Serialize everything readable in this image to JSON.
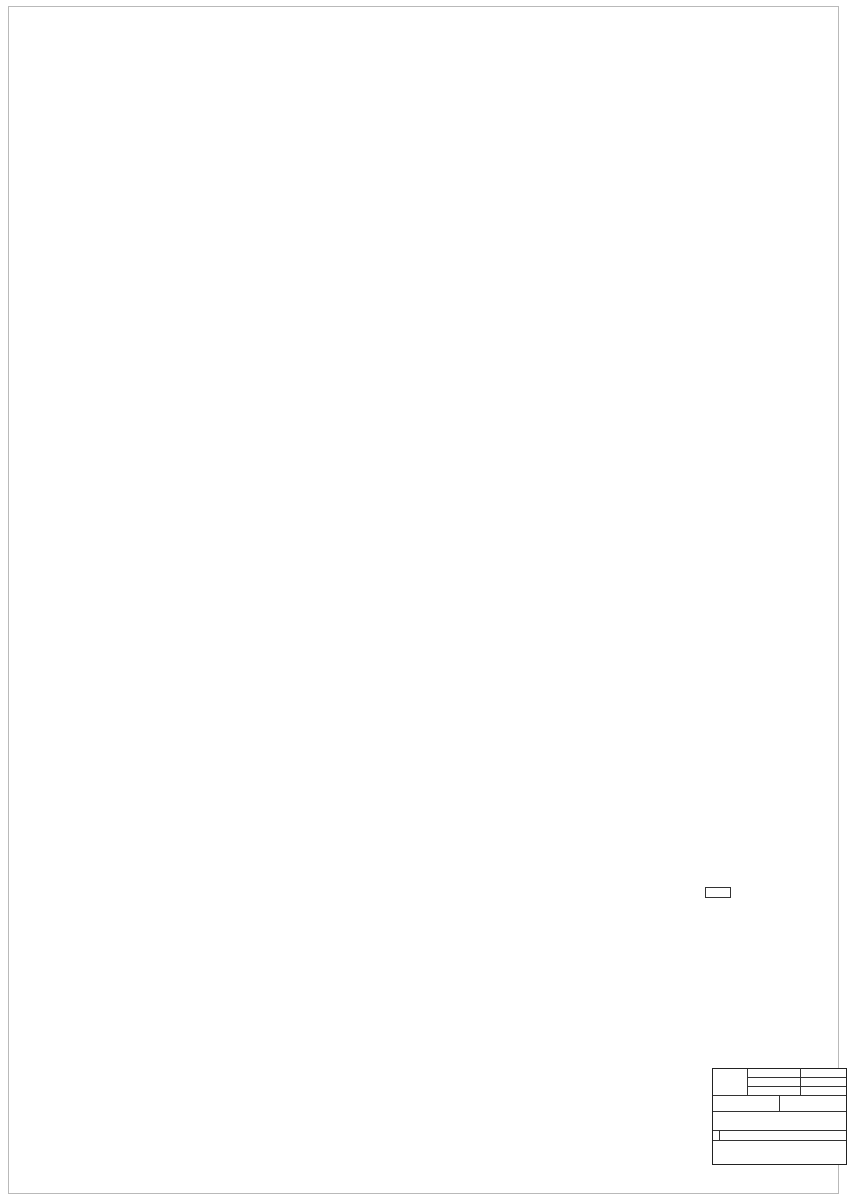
{
  "legend_materials": {
    "title": "LEGENDA MATERIÁLŮ",
    "items": [
      {
        "label": "STÁVAJÍCÍ CIHELNÉ ZDIVO",
        "swatch": "#c4c4c4"
      }
    ]
  },
  "legend_rooms": {
    "title": "LEGENDA MÍSTNOSTÍ",
    "headers": [
      "Č.M.",
      "NÁZEV MÍSTNOSTI",
      "PLOCHA m2",
      "DRUH PODLAHY"
    ],
    "rows": [
      [
        "101",
        "HALA",
        "95,30",
        "BETON"
      ],
      [
        "102",
        "SKLAD",
        "28,5",
        "BETON"
      ],
      [
        "103",
        "SKLAD",
        "39,45",
        "BETON"
      ],
      [
        "104",
        "CHODBA",
        "15,80",
        "BETON"
      ],
      [
        "105",
        "SCHODIŠTĚ",
        "3,30",
        "BETON"
      ],
      [
        "106",
        "SKLAD",
        "18,46",
        "BETON"
      ],
      [
        "107",
        "WC",
        "2,75",
        "BETON"
      ],
      [
        "108",
        "SKLAD",
        "56,1",
        "BETON"
      ],
      [
        "109",
        "SKLAD",
        "17,90",
        "BETON"
      ],
      [
        "110",
        "SKLAD",
        "22,80",
        "BETON"
      ]
    ],
    "footer_line1": "CELKOVÁ UŽITNÁ PLOCHA",
    "footer_line2": "1NP OBJEKTU JE - 300,3 M2"
  },
  "titleblock": {
    "datum_label": "DATUM",
    "datum": "4/2025",
    "stupen_label": "STUPEŇ",
    "stupen": "PASPORT",
    "format_label": "FORMÁT",
    "format": "A1",
    "meritko_label": "MĚŘÍTKO",
    "meritko": "1:50",
    "cislo_label": "Č.",
    "cislo": "D1.1 - 1",
    "rows": [
      [
        "AUTORIZOVANÝ PROJEKTANT",
        "ING. MIROSLAV KRAMÁŘ"
      ],
      [
        "VYPRACOVAL",
        "ING. TOMÁŠ CHUDÝ"
      ],
      [
        "OBEC",
        "OKROUHLICE"
      ],
      [
        "KATASTRÁLNÍ ÚZEMÍ",
        "OKROUHLICE (709654)"
      ],
      [
        "INVESTOR",
        "B1 KLIMA a.s. HYBEŠOVA 256/18, STARÉ BRNO, 60200 BRNO"
      ]
    ],
    "stavba_label": "STAVBA",
    "stavba": "OKROUHLICE Č. PO. 58, PA. Č. 67/3",
    "part_code": "D.1.1",
    "part_name": "ARCHITEKTONICKO-STAVEBNÍ ŘEŠENÍ",
    "obsah_label": "OBSAH",
    "obsah": "PŮDORYS 1NP - STÁVAJÍCÍ STAV"
  },
  "plan": {
    "accent_dim_color": "#3b3bb0",
    "room_color": "#2ba2a2",
    "neighbor_color_top": "#63cfcf",
    "neighbor_color_bottom": "#dd9a55",
    "rooms": [
      {
        "num": "1.01",
        "name": "HALA",
        "x": 520,
        "y": 268
      },
      {
        "num": "1.02",
        "name": "SKLAD",
        "x": 268,
        "y": 272
      },
      {
        "num": "1.03",
        "name": "SKLAD",
        "x": 270,
        "y": 521
      },
      {
        "num": "1.04",
        "name": "CHODBA",
        "x": 388,
        "y": 532
      },
      {
        "num": "1.05",
        "name": "SCHODIŠTĚ",
        "x": 489,
        "y": 545
      },
      {
        "num": "1.06",
        "name": "SKLAD",
        "x": 579,
        "y": 464
      },
      {
        "num": "1.07",
        "name": "WC",
        "x": 377,
        "y": 630
      },
      {
        "num": "1.08",
        "name": "SKLAD",
        "x": 423,
        "y": 643
      },
      {
        "num": "1.09",
        "name": "SKLAD",
        "x": 413,
        "y": 786
      },
      {
        "num": "1.10",
        "name": "SKLAD",
        "x": 542,
        "y": 786
      }
    ],
    "levels": [
      {
        "x": 512,
        "y": 203,
        "t": "0,000",
        "sv": "SV. 3950"
      },
      {
        "x": 275,
        "y": 322,
        "t": "0,000",
        "sv": "SV. 3950"
      },
      {
        "x": 298,
        "y": 402,
        "t": "0,000",
        "sv": "SV. 3950"
      },
      {
        "x": 290,
        "y": 502,
        "t": "0,000",
        "sv": "SV. 3200"
      },
      {
        "x": 408,
        "y": 551,
        "t": "-0,050",
        "sv": "SV. 3000"
      },
      {
        "x": 614,
        "y": 466,
        "t": "0,000",
        "sv": "SV. 2520"
      },
      {
        "x": 470,
        "y": 562,
        "t": "+1,180"
      },
      {
        "x": 412,
        "y": 667,
        "t": "-0,250",
        "sv": "SV. 2950"
      },
      {
        "x": 591,
        "y": 667,
        "t": "-0,250",
        "sv": "SV. 2950"
      },
      {
        "x": 413,
        "y": 803,
        "t": "-0,250",
        "sv": "SV. 2500"
      },
      {
        "x": 542,
        "y": 803,
        "t": "-0,250",
        "sv": "SV. 2500"
      },
      {
        "x": 303,
        "y": 147,
        "t": "-0,030"
      },
      {
        "x": 471,
        "y": 117,
        "t": "-0,625"
      },
      {
        "x": 485,
        "y": 139,
        "t": "-0,315"
      }
    ],
    "dims": [
      {
        "x": 630,
        "y": 48,
        "t": "17600"
      },
      {
        "x": 255,
        "y": 60,
        "t": "5600"
      },
      {
        "x": 515,
        "y": 60,
        "t": "12100"
      },
      {
        "x": 228,
        "y": 74,
        "t": "2310"
      },
      {
        "x": 340,
        "y": 74,
        "t": "2630"
      },
      {
        "x": 436,
        "y": 74,
        "t": "560"
      },
      {
        "x": 470,
        "y": 74,
        "t": "1690"
      },
      {
        "x": 552,
        "y": 71,
        "t": "1260"
      },
      {
        "x": 552,
        "y": 77,
        "t": "2130(870)",
        "fs": 3.2
      },
      {
        "x": 600,
        "y": 74,
        "t": "1150"
      },
      {
        "x": 633,
        "y": 74,
        "t": "1170"
      },
      {
        "x": 666,
        "y": 71,
        "t": "2320(970)",
        "fs": 3.2
      },
      {
        "x": 686,
        "y": 74,
        "t": "1610"
      },
      {
        "x": 200,
        "y": 86,
        "t": "590"
      },
      {
        "x": 240,
        "y": 86,
        "t": "1720"
      },
      {
        "x": 292,
        "y": 84,
        "t": "1200"
      },
      {
        "x": 292,
        "y": 90,
        "t": "2110(870)",
        "fs": 3.2
      },
      {
        "x": 352,
        "y": 84,
        "t": "1430"
      },
      {
        "x": 352,
        "y": 90,
        "t": "2000"
      },
      {
        "x": 460,
        "y": 86,
        "t": "1200"
      },
      {
        "x": 460,
        "y": 92,
        "t": "2110(870)",
        "fs": 3.2
      },
      {
        "x": 528,
        "y": 86,
        "t": "2000"
      },
      {
        "x": 590,
        "y": 84,
        "t": "1200"
      },
      {
        "x": 590,
        "y": 90,
        "t": "2110(880)",
        "fs": 3.2
      },
      {
        "x": 650,
        "y": 86,
        "t": "1670"
      },
      {
        "x": 528,
        "y": 96,
        "t": "2700"
      },
      {
        "x": 512,
        "y": 104,
        "t": "2100"
      },
      {
        "x": 558,
        "y": 104,
        "t": "600"
      },
      {
        "x": 578,
        "y": 134,
        "t": "1450",
        "r": 1
      },
      {
        "x": 536,
        "y": 121,
        "t": "140 160/230",
        "fs": 3
      },
      {
        "x": 544,
        "y": 129,
        "t": "2x740(2x160)-2x780",
        "fs": 3
      },
      {
        "x": 115,
        "y": 520,
        "t": "25290",
        "r": 1
      },
      {
        "x": 128,
        "y": 345,
        "t": "11050",
        "r": 1
      },
      {
        "x": 128,
        "y": 765,
        "t": "5840",
        "r": 1
      },
      {
        "x": 144,
        "y": 170,
        "t": "870",
        "r": 1
      },
      {
        "x": 144,
        "y": 200,
        "t": "1140",
        "r": 1
      },
      {
        "x": 144,
        "y": 235,
        "t": "1580(2110)",
        "r": 1,
        "fs": 3.2
      },
      {
        "x": 144,
        "y": 300,
        "t": "4350",
        "r": 1
      },
      {
        "x": 144,
        "y": 362,
        "t": "1020",
        "r": 1
      },
      {
        "x": 144,
        "y": 422,
        "t": "1970",
        "r": 1
      },
      {
        "x": 144,
        "y": 468,
        "t": "980",
        "r": 1
      },
      {
        "x": 144,
        "y": 502,
        "t": "490",
        "r": 1
      },
      {
        "x": 144,
        "y": 535,
        "t": "1000(1700)",
        "r": 1,
        "fs": 3.2
      },
      {
        "x": 144,
        "y": 572,
        "t": "1530",
        "r": 1
      },
      {
        "x": 160,
        "y": 592,
        "t": "520",
        "r": 1,
        "fs": 3.4
      },
      {
        "x": 144,
        "y": 618,
        "t": "1170",
        "r": 1
      },
      {
        "x": 144,
        "y": 648,
        "t": "870",
        "r": 1
      },
      {
        "x": 144,
        "y": 678,
        "t": "1170",
        "r": 1
      },
      {
        "x": 144,
        "y": 712,
        "t": "1000",
        "r": 1
      },
      {
        "x": 144,
        "y": 755,
        "t": "1320",
        "r": 1
      },
      {
        "x": 144,
        "y": 835,
        "t": "3960",
        "r": 1
      },
      {
        "x": 716,
        "y": 350,
        "t": "13325",
        "r": 1
      },
      {
        "x": 676,
        "y": 387,
        "t": "710",
        "fs": 3.4
      },
      {
        "x": 659,
        "y": 397,
        "t": "900",
        "fs": 3.4
      },
      {
        "x": 242,
        "y": 899,
        "t": "5490"
      },
      {
        "x": 362,
        "y": 899,
        "t": "1715"
      },
      {
        "x": 404,
        "y": 897,
        "t": "1000"
      },
      {
        "x": 404,
        "y": 903,
        "t": "1470(810)",
        "fs": 3.2
      },
      {
        "x": 446,
        "y": 899,
        "t": "1970"
      },
      {
        "x": 512,
        "y": 897,
        "t": "1000"
      },
      {
        "x": 512,
        "y": 903,
        "t": "1560(810)",
        "fs": 3.2
      },
      {
        "x": 550,
        "y": 906,
        "t": "1590",
        "fs": 3.6
      },
      {
        "x": 625,
        "y": 899,
        "t": "5905"
      },
      {
        "x": 424,
        "y": 911,
        "t": "17280"
      },
      {
        "x": 545,
        "y": 919,
        "t": "(11590)",
        "fs": 3.4
      },
      {
        "x": 270,
        "y": 287,
        "t": "4950"
      },
      {
        "x": 237,
        "y": 302,
        "t": "3060"
      },
      {
        "x": 303,
        "y": 300,
        "t": "1270"
      },
      {
        "x": 303,
        "y": 306,
        "t": "2100"
      },
      {
        "x": 333,
        "y": 302,
        "t": "620"
      },
      {
        "x": 215,
        "y": 290,
        "t": "650",
        "fs": 3.4
      },
      {
        "x": 250,
        "y": 388,
        "t": "4960"
      },
      {
        "x": 222,
        "y": 396,
        "t": "1120"
      },
      {
        "x": 290,
        "y": 396,
        "t": "3180"
      },
      {
        "x": 278,
        "y": 403,
        "t": "2270"
      },
      {
        "x": 552,
        "y": 382,
        "t": "10950"
      },
      {
        "x": 540,
        "y": 390,
        "t": "5530"
      },
      {
        "x": 612,
        "y": 390,
        "t": "1900"
      },
      {
        "x": 648,
        "y": 390,
        "t": "2300(2150)",
        "fs": 3
      },
      {
        "x": 390,
        "y": 388,
        "t": "1170",
        "fs": 3.4
      },
      {
        "x": 417,
        "y": 389,
        "t": "1250"
      },
      {
        "x": 417,
        "y": 396,
        "t": "2200"
      },
      {
        "x": 449,
        "y": 240,
        "t": "4750",
        "r": 1
      },
      {
        "x": 457,
        "y": 310,
        "t": "8700",
        "r": 1
      },
      {
        "x": 437,
        "y": 375,
        "t": "3170",
        "r": 1,
        "fs": 3.4
      },
      {
        "x": 462,
        "y": 322,
        "t": "780",
        "fs": 3.2
      },
      {
        "x": 212,
        "y": 460,
        "t": "1290"
      },
      {
        "x": 280,
        "y": 468,
        "t": "8750"
      },
      {
        "x": 246,
        "y": 505,
        "t": "4410",
        "r": 1
      },
      {
        "x": 381,
        "y": 505,
        "t": "580",
        "fs": 3.4
      },
      {
        "x": 404,
        "y": 518,
        "t": "1650"
      },
      {
        "x": 438,
        "y": 546,
        "t": "1100",
        "fs": 3.4
      },
      {
        "x": 464,
        "y": 546,
        "t": "1410",
        "fs": 3.4
      },
      {
        "x": 433,
        "y": 481,
        "t": "4250"
      },
      {
        "x": 586,
        "y": 483,
        "t": "4675"
      },
      {
        "x": 645,
        "y": 474,
        "t": "600",
        "fs": 3.4
      },
      {
        "x": 612,
        "y": 492,
        "t": "2875"
      },
      {
        "x": 612,
        "y": 533,
        "t": "2875"
      },
      {
        "x": 600,
        "y": 566,
        "t": "3615"
      },
      {
        "x": 608,
        "y": 500,
        "t": "2030(2060)",
        "fs": 3
      },
      {
        "x": 393,
        "y": 597,
        "t": "110",
        "fs": 3
      },
      {
        "x": 407,
        "y": 597,
        "t": "1170",
        "fs": 3.4
      },
      {
        "x": 402,
        "y": 604,
        "t": "2260",
        "fs": 3.4
      },
      {
        "x": 412,
        "y": 629,
        "t": "4210"
      },
      {
        "x": 439,
        "y": 615,
        "t": "2950",
        "r": 1,
        "fs": 3.4
      },
      {
        "x": 504,
        "y": 688,
        "t": "9880"
      },
      {
        "x": 424,
        "y": 721,
        "t": "5290"
      },
      {
        "x": 456,
        "y": 710,
        "t": "3050",
        "r": 1,
        "fs": 3.4
      },
      {
        "x": 386,
        "y": 712,
        "t": "1080",
        "fs": 3.4
      },
      {
        "x": 588,
        "y": 629,
        "t": "4170"
      },
      {
        "x": 583,
        "y": 663,
        "t": "8150",
        "r": 1,
        "fs": 3.4
      },
      {
        "x": 600,
        "y": 601,
        "t": "1180",
        "fs": 3.4
      },
      {
        "x": 650,
        "y": 601,
        "t": "1140",
        "fs": 3.4
      },
      {
        "x": 624,
        "y": 608,
        "t": "2000(2150)",
        "fs": 3
      },
      {
        "x": 520,
        "y": 723,
        "t": "470",
        "fs": 3.4
      },
      {
        "x": 588,
        "y": 721,
        "t": "4170"
      },
      {
        "x": 653,
        "y": 721,
        "t": "900",
        "fs": 3.4
      },
      {
        "x": 344,
        "y": 822,
        "t": "440",
        "r": 1,
        "fs": 3.4
      },
      {
        "x": 408,
        "y": 825,
        "t": "3860"
      },
      {
        "x": 441,
        "y": 812,
        "t": "2730",
        "r": 1
      },
      {
        "x": 472,
        "y": 824,
        "t": "320",
        "fs": 3.4
      },
      {
        "x": 553,
        "y": 825,
        "t": "4075"
      },
      {
        "x": 662,
        "y": 812,
        "t": "2730",
        "r": 1
      },
      {
        "x": 487,
        "y": 776,
        "t": "980",
        "fs": 3
      },
      {
        "x": 487,
        "y": 782,
        "t": "2000",
        "fs": 3
      },
      {
        "x": 470,
        "y": 776,
        "t": "300",
        "fs": 3
      }
    ],
    "notes": [
      {
        "x": 723,
        "y": 137,
        "t": "SOUSEDNÍ OBJEKT",
        "c": "#63cfcf",
        "fs": 4
      },
      {
        "x": 567,
        "y": 956,
        "t": "SOUSEDNÍ OBJEKT",
        "c": "#dd9a55",
        "fs": 4
      },
      {
        "x": 659,
        "y": 377,
        "t": "EL.",
        "c": "#333333",
        "fs": 3.2
      },
      {
        "x": 470,
        "y": 459,
        "t": "DRAŽICE",
        "c": "#333333",
        "fs": 2.6
      },
      {
        "x": 463,
        "y": 479,
        "t": "DK01",
        "c": "#333333",
        "fs": 3
      },
      {
        "x": 463,
        "y": 484,
        "t": "DPK03",
        "c": "#333333",
        "fs": 2.8
      },
      {
        "x": 463,
        "y": 506,
        "t": "DK01",
        "c": "#333333",
        "fs": 3
      },
      {
        "x": 463,
        "y": 511,
        "t": "DPK03",
        "c": "#333333",
        "fs": 2.8
      },
      {
        "x": 489,
        "y": 501,
        "t": "VÝLEZ DO SKLEPA",
        "c": "#333333",
        "fs": 3.2
      },
      {
        "x": 444,
        "y": 554,
        "t": "5x193x280",
        "c": "#333333",
        "fs": 3
      }
    ]
  }
}
